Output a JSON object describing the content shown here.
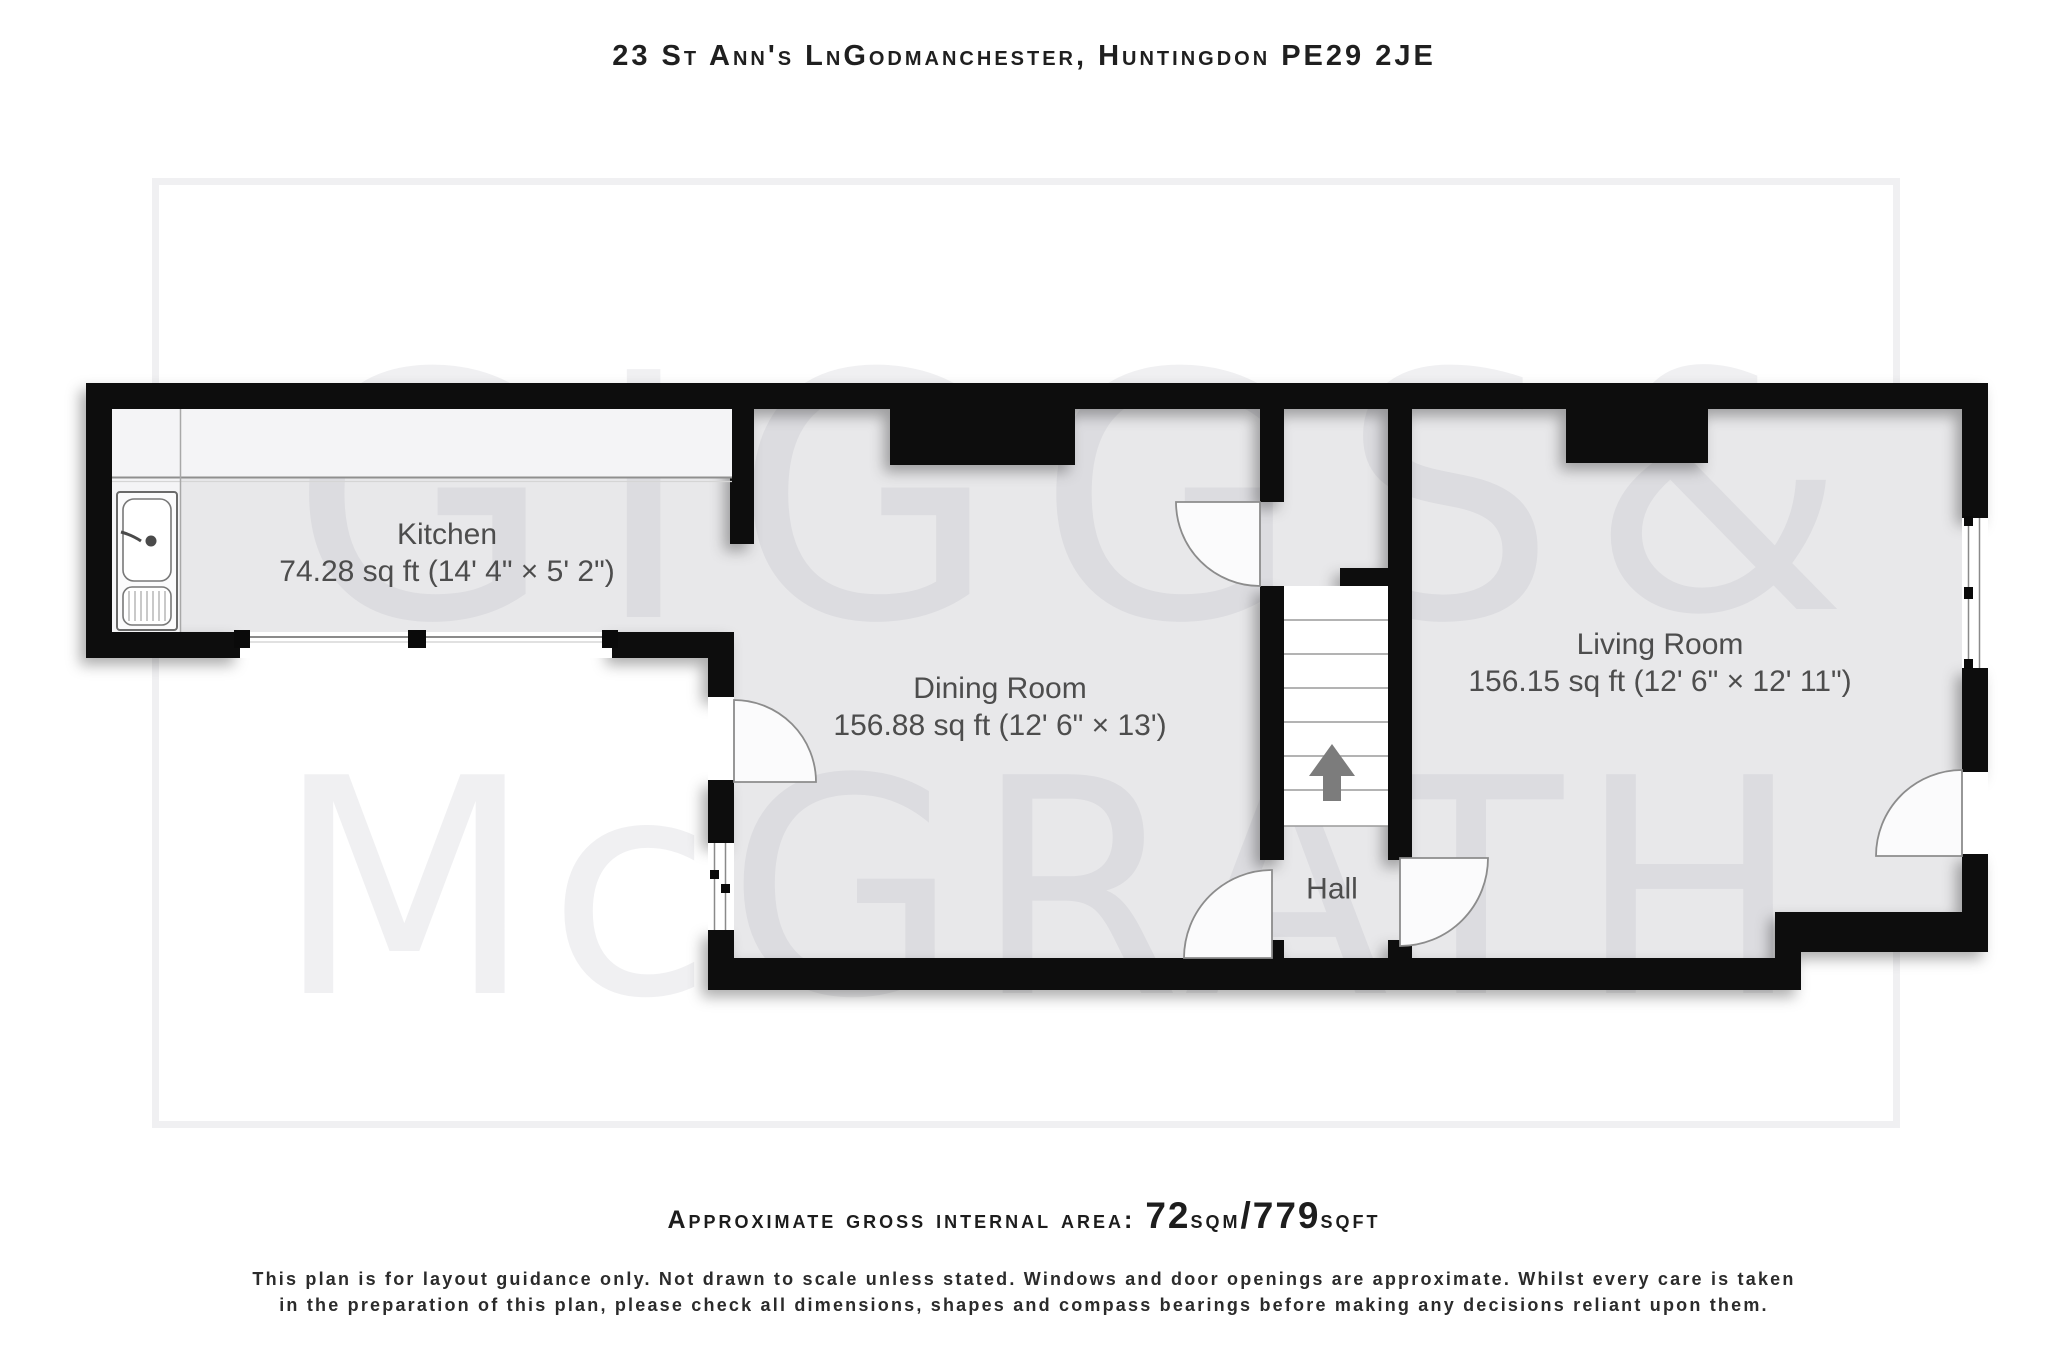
{
  "title": "23 St Ann's LnGodmanchester, Huntingdon PE29 2JE",
  "watermark": {
    "word1": "GIGGS",
    "ampersand": "&",
    "word2": "McGRATH"
  },
  "rooms": {
    "kitchen": {
      "name": "Kitchen",
      "dims": "74.28 sq ft (14' 4\" × 5' 2\")"
    },
    "dining": {
      "name": "Dining Room",
      "dims": "156.88 sq ft (12' 6\" × 13')"
    },
    "living": {
      "name": "Living Room",
      "dims": "156.15 sq ft (12' 6\" × 12' 11\")"
    },
    "hall": {
      "name": "Hall"
    }
  },
  "footer": {
    "area_label": "Approximate gross internal area:",
    "area_sqm_value": "72",
    "area_sqm_unit": "sqm",
    "area_slash": "/",
    "area_sqft_value": "779",
    "area_sqft_unit": "sqft",
    "disclaimer_line1": "This plan is for layout guidance only. Not drawn to scale unless stated. Windows and door openings are approximate. Whilst every care is taken",
    "disclaimer_line2": "in the preparation of this plan, please check all dimensions, shapes and compass bearings before making any decisions reliant upon them."
  },
  "colors": {
    "wall": "#0a0a0a",
    "floor": "#e8e8ea",
    "counter": "#f4f4f6",
    "label_text": "#4d4d4d"
  }
}
